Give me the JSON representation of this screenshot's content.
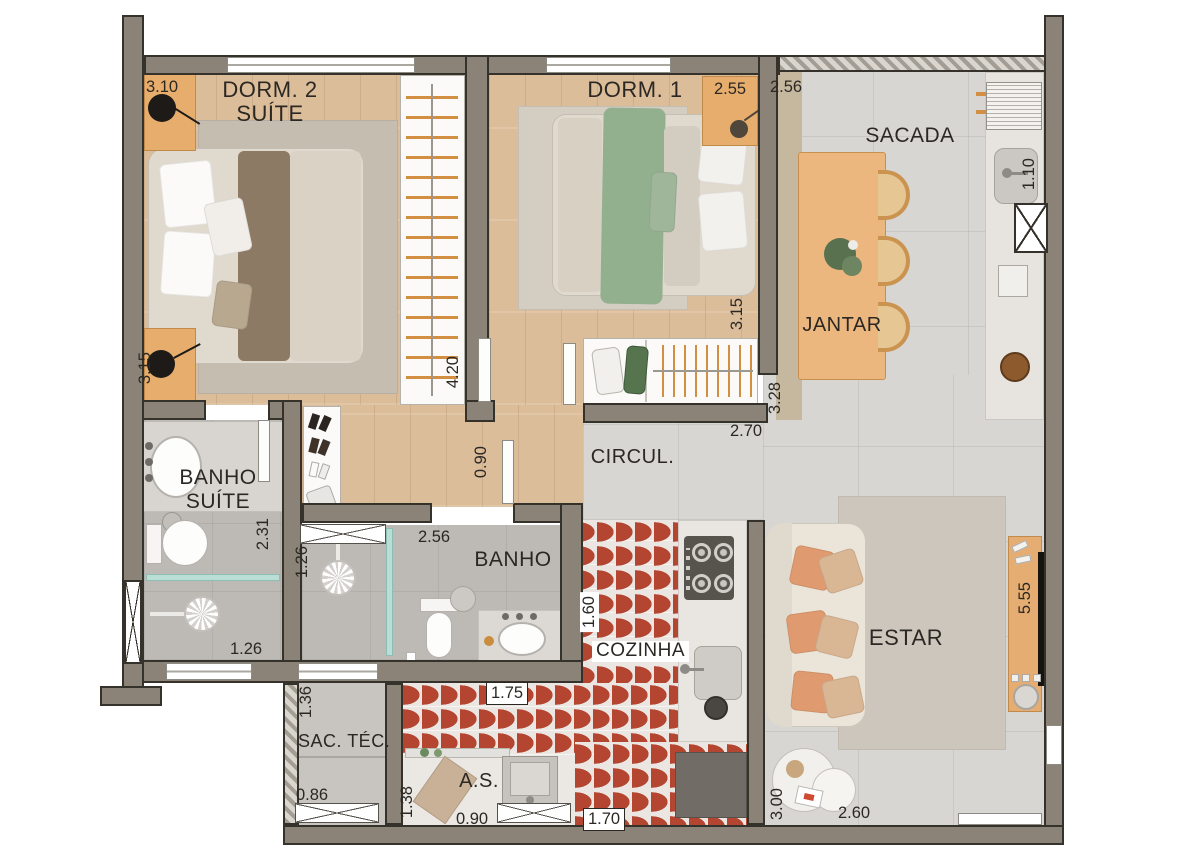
{
  "rooms": {
    "dorm2_l1": "DORM. 2",
    "dorm2_l2": "SUÍTE",
    "dorm1": "DORM. 1",
    "sacada": "SACADA",
    "jantar": "JANTAR",
    "circul": "CIRCUL.",
    "banho_suite_l1": "BANHO",
    "banho_suite_l2": "SUÍTE",
    "banho": "BANHO",
    "cozinha": "COZINHA",
    "estar": "ESTAR",
    "sac_tec": "SAC. TÉC.",
    "area_servico": "A.S."
  },
  "dims": {
    "dorm2_width": "3.10",
    "dorm1_width": "2.55",
    "sacada_top": "2.56",
    "sacada_counter": "1.10",
    "dorm2_depth": "3.15",
    "dorm1_depth": "3.15",
    "dorm2_closet": "4.20",
    "jantar_depth": "3.28",
    "circul_width": "2.70",
    "hall_width": "0.90",
    "banho_suite_depth": "2.31",
    "banho_suite_width": "1.26",
    "banho_shower": "1.26",
    "banho_width": "2.56",
    "cozinha_pass_top": "1.60",
    "cozinha_pass_mid": "1.75",
    "sac_tec_depth": "1.36",
    "sac_tec_width": "0.86",
    "as_depth": "1.38",
    "as_width": "0.90",
    "cozinha_bottom": "1.70",
    "estar_length": "5.55",
    "estar_depth": "3.00",
    "estar_width": "2.60"
  },
  "colors": {
    "wall": "#8b8378",
    "wall_outline": "#35312b",
    "wood_floor": "#dcbd9a",
    "tile_floor": "#d8d6d3",
    "bath_floor": "#bdbab6",
    "kitchen_tile_red": "#b44531",
    "furniture_wood": "#e7ad6c",
    "sofa_cream": "#eae4d9",
    "pillow_orange": "#df9b6f",
    "bed_green": "#92af8e",
    "bed_brown": "#8d7a64",
    "shower_glass": "#b9ded6"
  }
}
